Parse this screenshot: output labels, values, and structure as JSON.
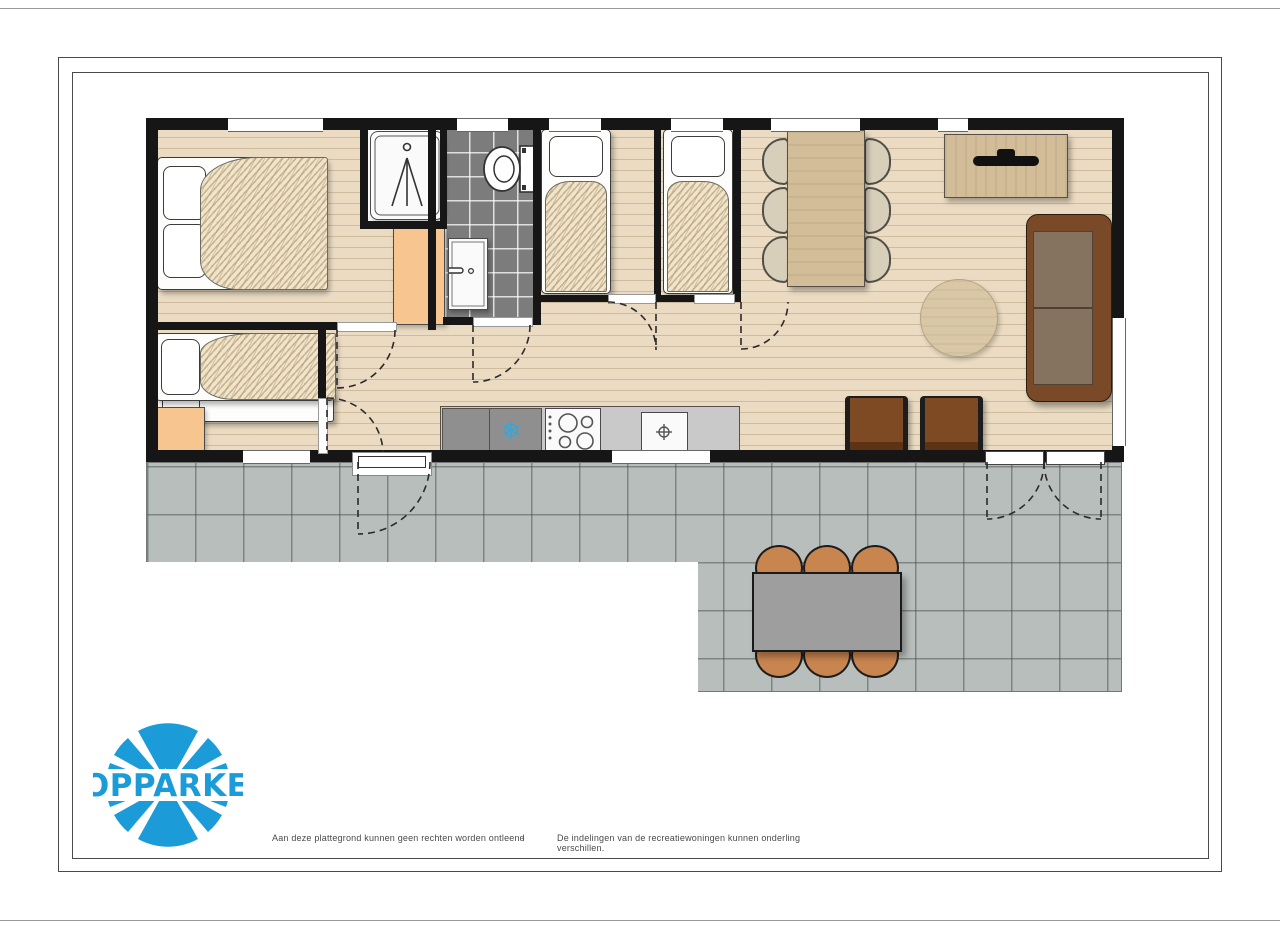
{
  "brand": {
    "logo_text": "TOPPARKEN",
    "logo_color": "#1b9cd8"
  },
  "footer": {
    "disclaimer_left": "Aan deze plattegrond kunnen geen rechten worden ontleend",
    "separator": "-",
    "disclaimer_right": "De indelingen van de recreatiewoningen kunnen onderling verschillen."
  },
  "floorplan": {
    "type": "holiday-home top-view floor plan with terrace",
    "rooms": [
      {
        "name": "master-bedroom",
        "furniture": [
          "double-bed"
        ]
      },
      {
        "name": "bunk-bedroom",
        "furniture": [
          "bunk-bed",
          "orange-cabinet"
        ]
      },
      {
        "name": "shower-room",
        "furniture": [
          "shower-tray"
        ]
      },
      {
        "name": "bathroom",
        "furniture": [
          "toilet",
          "washbasin"
        ],
        "floor": "dark-grey-tiles"
      },
      {
        "name": "wardrobe-niche",
        "furniture": [
          "orange-wardrobe"
        ]
      },
      {
        "name": "single-bedroom-1",
        "furniture": [
          "single-bed"
        ]
      },
      {
        "name": "single-bedroom-2",
        "furniture": [
          "single-bed"
        ]
      },
      {
        "name": "living-dining-kitchen",
        "furniture": [
          "dining-table",
          "six-dining-chairs",
          "tv-sideboard",
          "sofa",
          "two-armchairs",
          "round-rug",
          "kitchen-counter",
          "fridge-freezer",
          "cooktop",
          "sink"
        ]
      },
      {
        "name": "terrace",
        "furniture": [
          "outdoor-table",
          "six-outdoor-chairs"
        ],
        "floor": "grey-tiles"
      }
    ],
    "doors": [
      "front-door-to-terrace",
      "french-doors-to-terrace",
      "master-bedroom-door",
      "bathroom-door",
      "bunk-bedroom-door",
      "single-bedroom-1-door",
      "single-bedroom-2-door"
    ],
    "colors": {
      "wall": "#161616",
      "wood_floor": "#eadbc2",
      "terrace_tile": "#b8bebb",
      "bathroom_tile": "#7c7c7c",
      "cabinet_orange": "#f7c590",
      "furniture_tan": "#d3bd98",
      "sofa_brown": "#7a4a28",
      "sofa_cushion": "#857360",
      "armchair_brown": "#7d4a24",
      "outdoor_chair": "#c9854f",
      "outdoor_table": "#9e9e9e",
      "counter_grey": "#c9c9c9",
      "appliance_grey": "#8f8f8f",
      "snowflake_blue": "#2fa8e0",
      "logo_blue": "#1b9cd8"
    },
    "icons": [
      "snowflake-icon",
      "shower-icon",
      "toilet-icon",
      "sink-drain-icon",
      "tv-icon",
      "cooktop-burners-icon"
    ]
  }
}
